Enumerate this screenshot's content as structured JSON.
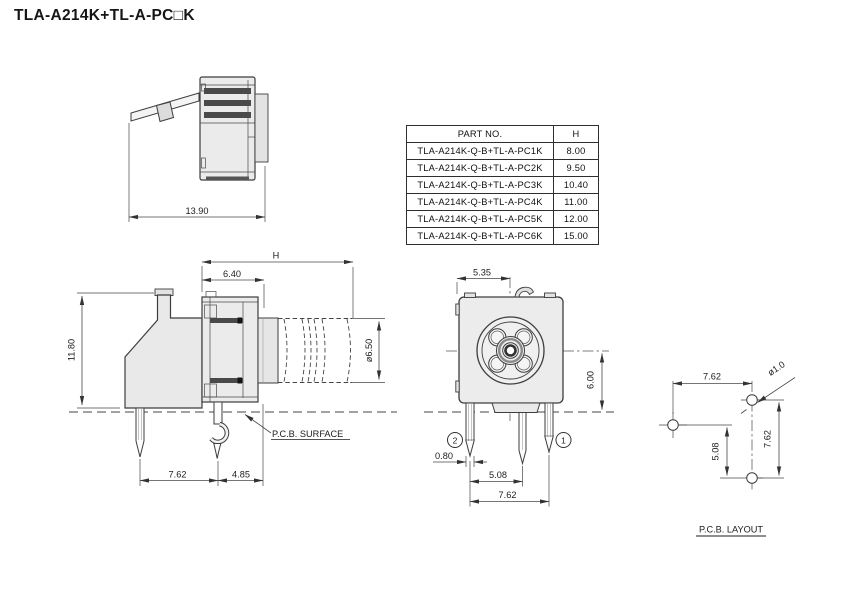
{
  "title": "TLA-A214K+TL-A-PC□K",
  "colors": {
    "line": "#3d3d3d",
    "body_fill": "#ebebeb",
    "dark_bar": "#4a4a4a",
    "background": "#ffffff"
  },
  "table": {
    "col_part": "PART NO.",
    "col_h": "H",
    "rows": [
      {
        "part": "TLA-A214K-Q-B+TL-A-PC1K",
        "h": "8.00"
      },
      {
        "part": "TLA-A214K-Q-B+TL-A-PC2K",
        "h": "9.50"
      },
      {
        "part": "TLA-A214K-Q-B+TL-A-PC3K",
        "h": "10.40"
      },
      {
        "part": "TLA-A214K-Q-B+TL-A-PC4K",
        "h": "11.00"
      },
      {
        "part": "TLA-A214K-Q-B+TL-A-PC5K",
        "h": "12.00"
      },
      {
        "part": "TLA-A214K-Q-B+TL-A-PC6K",
        "h": "15.00"
      }
    ]
  },
  "lever_view": {
    "width": "13.90"
  },
  "side_view": {
    "height_label": "H",
    "front_width": "6.40",
    "body_height": "11.80",
    "plunger_dia": "ø6.50",
    "surface_label": "P.C.B. SURFACE",
    "pin_span": "7.62",
    "pin_offset": "4.85"
  },
  "front_view": {
    "top_width": "5.35",
    "center_height": "6.00",
    "pin_width": "0.80",
    "pin_pitch_a": "5.08",
    "pin_pitch_b": "7.62",
    "terminal_1": "1",
    "terminal_2": "2"
  },
  "pcb_layout": {
    "h_pitch": "7.62",
    "hole_dia": "ø1.0",
    "v_pitch_a": "5.08",
    "v_pitch_b": "7.62",
    "label": "P.C.B. LAYOUT"
  }
}
